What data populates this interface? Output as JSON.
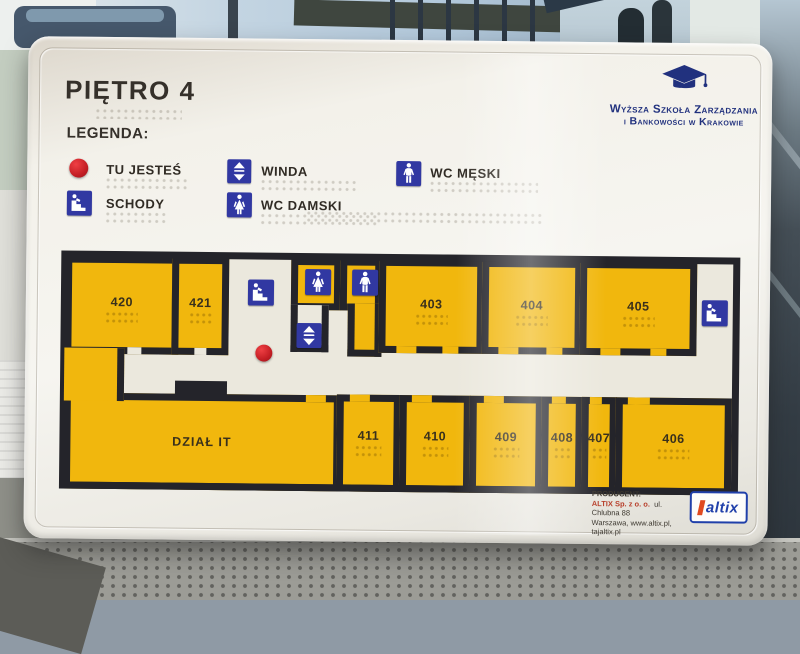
{
  "sign": {
    "title": "PIĘTRO 4",
    "legend": {
      "heading": "LEGENDA:",
      "items": [
        {
          "icon": "you-are-here-dot",
          "label": "TU JESTEŚ"
        },
        {
          "icon": "stairs-icon",
          "label": "SCHODY"
        },
        {
          "icon": "elevator-icon",
          "label": "WINDA"
        },
        {
          "icon": "wc-women-icon",
          "label": "WC DAMSKI"
        },
        {
          "icon": "wc-men-icon",
          "label": "WC MĘSKI"
        }
      ]
    },
    "logo": {
      "icon": "graduation-cap-icon",
      "line1": "Wyższa Szkoła Zarządzania",
      "line2": "i Bankowości w Krakowie"
    },
    "map": {
      "rooms": [
        {
          "label": "420"
        },
        {
          "label": "421"
        },
        {
          "label": "403"
        },
        {
          "label": "404"
        },
        {
          "label": "405"
        },
        {
          "label": "DZIAŁ IT"
        },
        {
          "label": "411"
        },
        {
          "label": "410"
        },
        {
          "label": "409"
        },
        {
          "label": "408"
        },
        {
          "label": "407"
        },
        {
          "label": "406"
        }
      ],
      "markers": [
        {
          "name": "stairs-icon"
        },
        {
          "name": "wc-women-icon"
        },
        {
          "name": "wc-men-icon"
        },
        {
          "name": "elevator-icon"
        },
        {
          "name": "you-are-here-dot"
        },
        {
          "name": "stairs-icon"
        }
      ],
      "colors": {
        "room_fill": "#f1b70d",
        "wall": "#24242a",
        "corridor": "#ebe8dd",
        "icon_blue": "#3138a2",
        "dot_red": "#d22027"
      }
    },
    "producer": {
      "heading": "PRODUCENT:",
      "company": "ALTIX Sp. z o. o.",
      "address": "ul. Chlubna 88",
      "city_line": "Warszawa,  www.altix.pl, tajaltix.pl",
      "brand": "altix"
    },
    "colors": {
      "board": "#f3f1ea",
      "logo_navy": "#21317e"
    }
  }
}
